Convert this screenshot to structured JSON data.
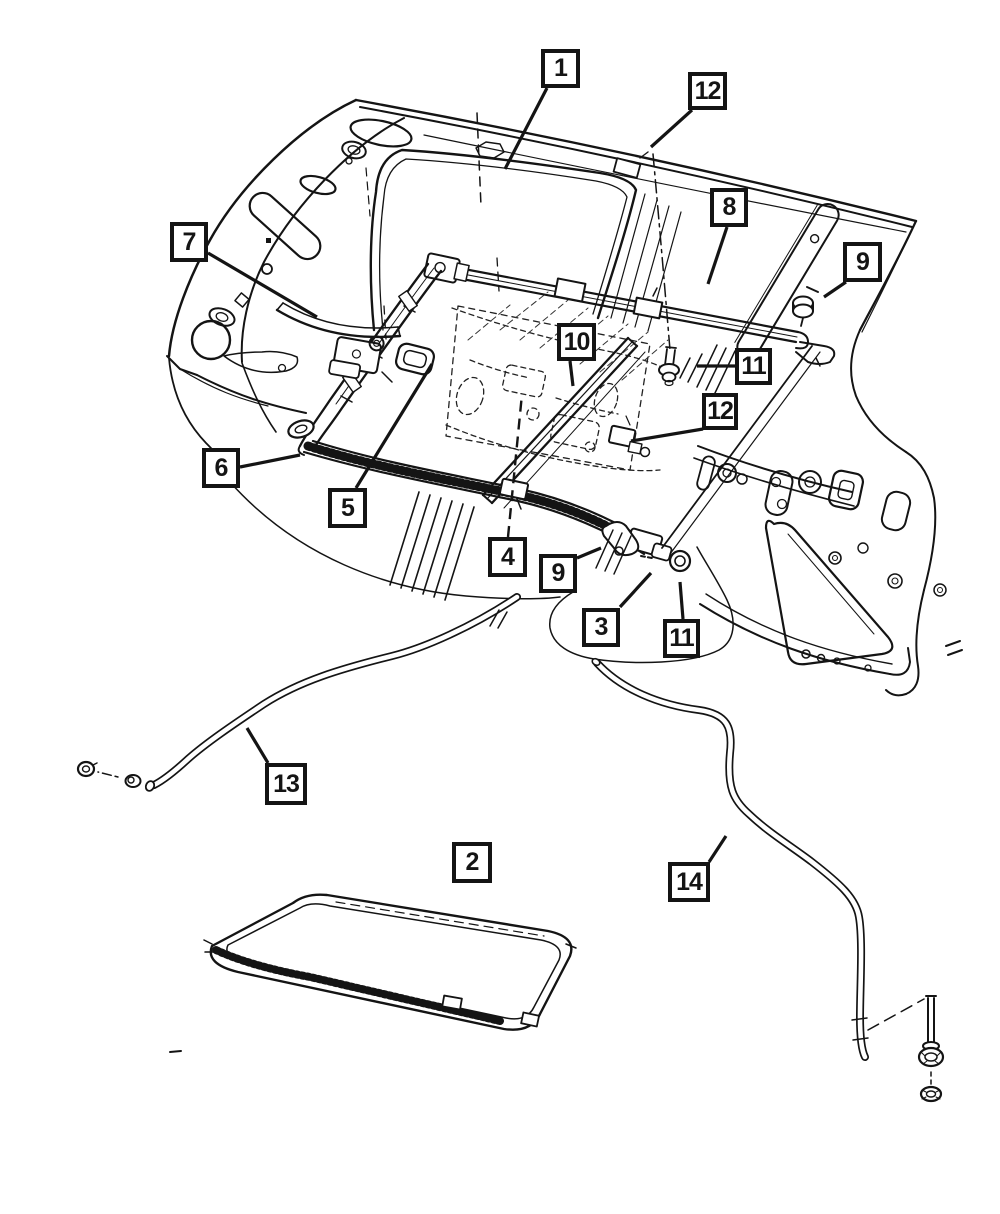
{
  "diagram": {
    "colors": {
      "background": "#ffffff",
      "line": "#141414"
    },
    "callouts": [
      {
        "label": "1",
        "x": 541,
        "y": 49,
        "w": 39,
        "h": 39,
        "leader": [
          [
            547,
            88
          ],
          [
            505,
            169
          ]
        ]
      },
      {
        "label": "12",
        "x": 688,
        "y": 72,
        "w": 39,
        "h": 38,
        "leader": [
          [
            692,
            110
          ],
          [
            651,
            147
          ]
        ]
      },
      {
        "label": "8",
        "x": 710,
        "y": 188,
        "w": 38,
        "h": 39,
        "leader": [
          [
            727,
            227
          ],
          [
            708,
            284
          ]
        ]
      },
      {
        "label": "9",
        "x": 843,
        "y": 242,
        "w": 39,
        "h": 40,
        "leader": [
          [
            846,
            282
          ],
          [
            824,
            297
          ]
        ]
      },
      {
        "label": "7",
        "x": 170,
        "y": 222,
        "w": 38,
        "h": 40,
        "leader": [
          [
            208,
            253
          ],
          [
            317,
            317
          ]
        ]
      },
      {
        "label": "10",
        "x": 557,
        "y": 323,
        "w": 39,
        "h": 38,
        "leader": [
          [
            570,
            361
          ],
          [
            573,
            386
          ]
        ]
      },
      {
        "label": "11",
        "x": 735,
        "y": 348,
        "w": 37,
        "h": 37,
        "leader": [
          [
            735,
            366
          ],
          [
            697,
            366
          ]
        ]
      },
      {
        "label": "12",
        "x": 702,
        "y": 393,
        "w": 36,
        "h": 37,
        "leader": [
          [
            703,
            429
          ],
          [
            631,
            441
          ]
        ]
      },
      {
        "label": "6",
        "x": 202,
        "y": 448,
        "w": 38,
        "h": 40,
        "leader": [
          [
            240,
            467
          ],
          [
            300,
            455
          ]
        ]
      },
      {
        "label": "5",
        "x": 328,
        "y": 488,
        "w": 39,
        "h": 40,
        "leader": [
          [
            356,
            488
          ],
          [
            432,
            364
          ]
        ]
      },
      {
        "label": "4",
        "x": 488,
        "y": 537,
        "w": 39,
        "h": 40,
        "leader": [
          [
            508,
            537
          ],
          [
            522,
            394
          ]
        ],
        "dashed": true
      },
      {
        "label": "9",
        "x": 539,
        "y": 554,
        "w": 38,
        "h": 39,
        "leader": [
          [
            577,
            558
          ],
          [
            601,
            548
          ]
        ]
      },
      {
        "label": "3",
        "x": 582,
        "y": 608,
        "w": 38,
        "h": 39,
        "leader": [
          [
            620,
            607
          ],
          [
            651,
            573
          ]
        ]
      },
      {
        "label": "11",
        "x": 663,
        "y": 619,
        "w": 37,
        "h": 39,
        "leader": [
          [
            683,
            619
          ],
          [
            680,
            582
          ]
        ]
      },
      {
        "label": "13",
        "x": 265,
        "y": 763,
        "w": 42,
        "h": 42,
        "leader": [
          [
            268,
            763
          ],
          [
            247,
            728
          ]
        ]
      },
      {
        "label": "2",
        "x": 452,
        "y": 842,
        "w": 40,
        "h": 41,
        "leader": []
      },
      {
        "label": "14",
        "x": 668,
        "y": 862,
        "w": 42,
        "h": 40,
        "leader": [
          [
            709,
            862
          ],
          [
            726,
            836
          ]
        ]
      }
    ]
  }
}
